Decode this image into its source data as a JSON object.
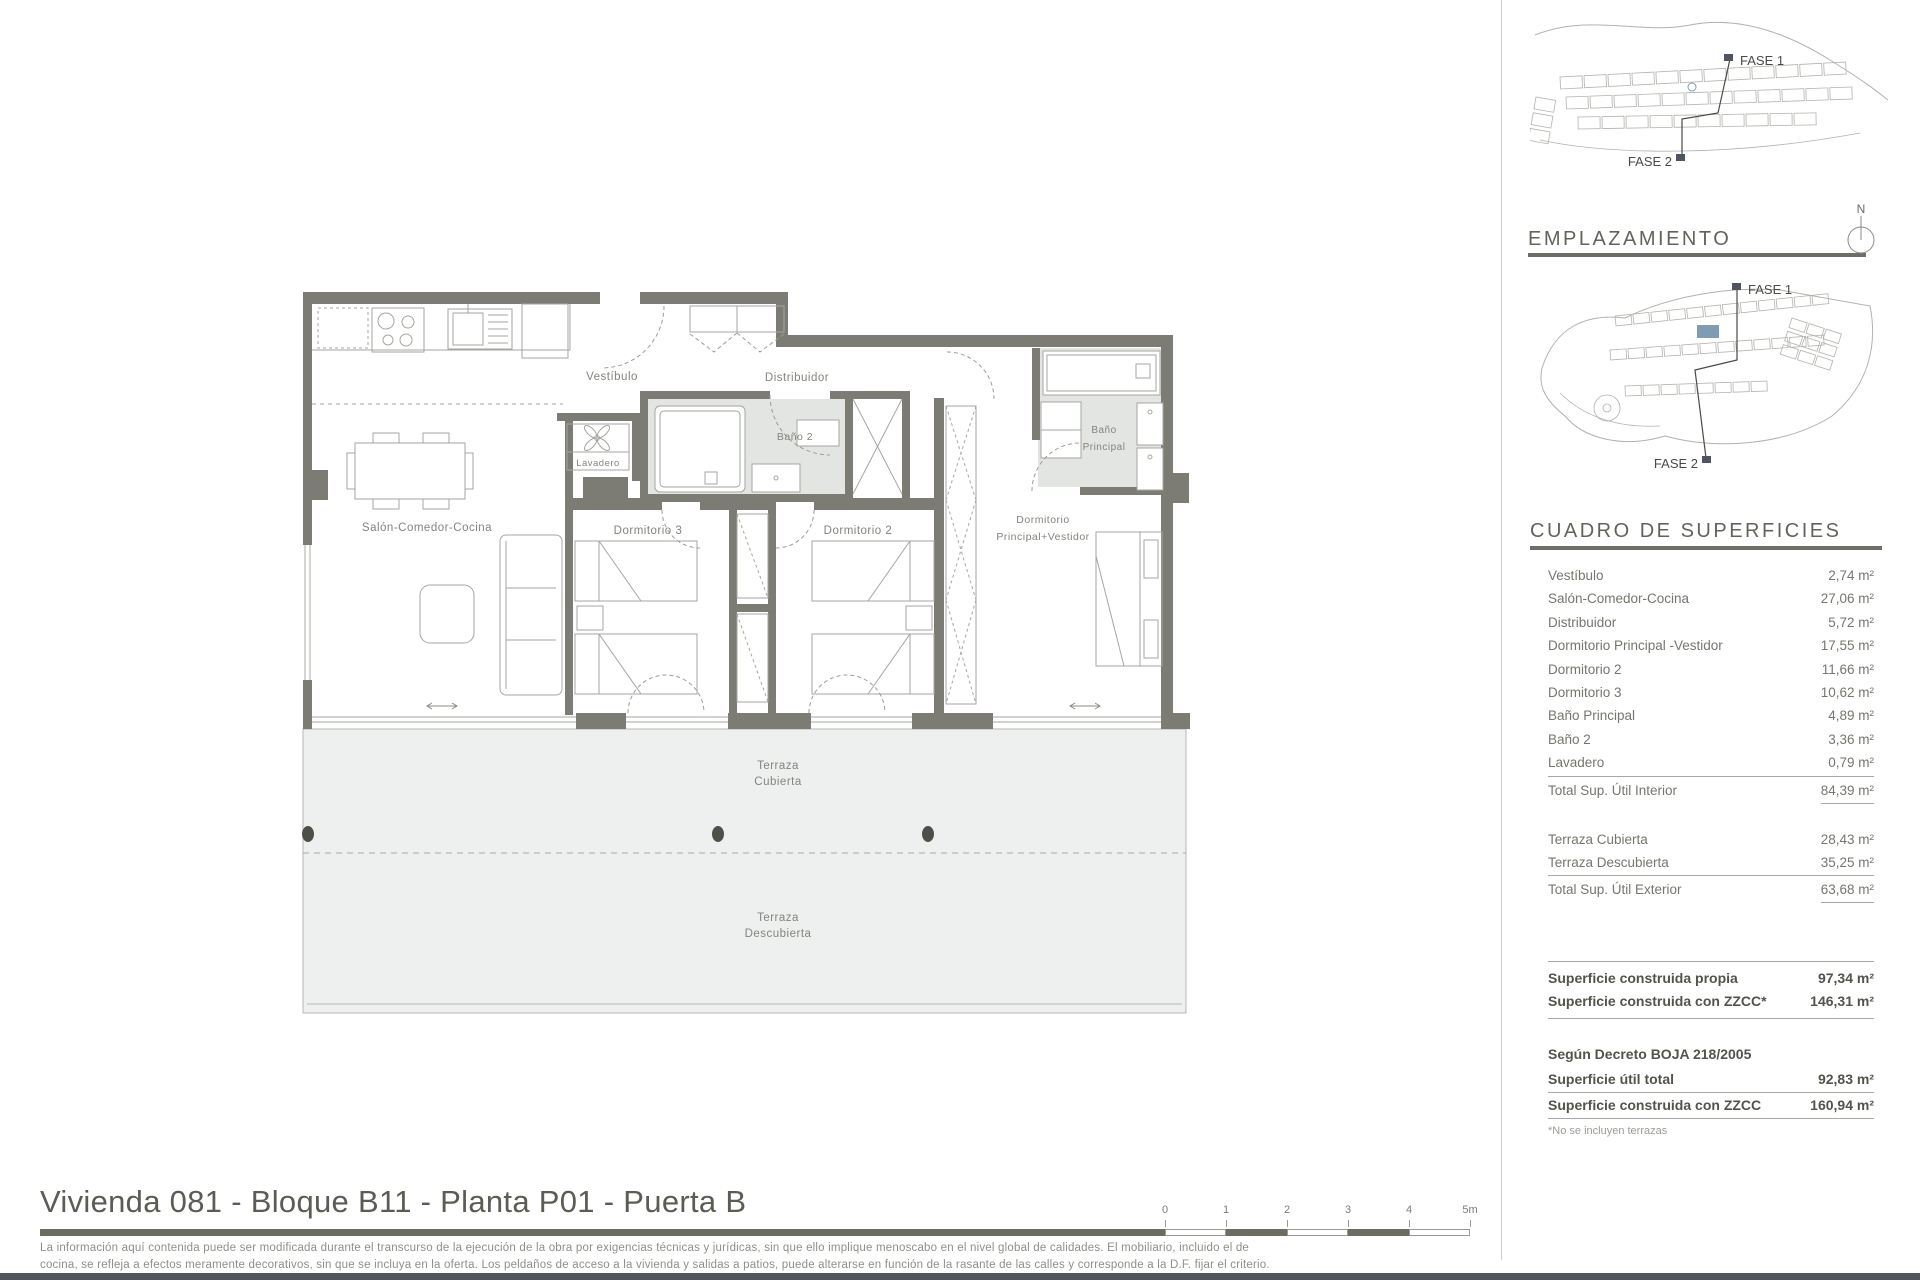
{
  "plan": {
    "labels": {
      "vestibulo": "Vestíbulo",
      "distribuidor": "Distribuidor",
      "bano2": "Baño 2",
      "lavadero": "Lavadero",
      "salon": "Salón-Comedor-Cocina",
      "dorm3": "Dormitorio 3",
      "dorm2": "Dormitorio 2",
      "dormppal_line1": "Dormitorio",
      "dormppal_line2": "Principal+Vestidor",
      "banoppal_line1": "Baño",
      "banoppal_line2": "Principal",
      "terraza_cubierta_line1": "Terraza",
      "terraza_cubierta_line2": "Cubierta",
      "terraza_descubierta_line1": "Terraza",
      "terraza_descubierta_line2": "Descubierta"
    },
    "scalebar_labels": [
      "0",
      "1",
      "2",
      "3",
      "4",
      "5m"
    ]
  },
  "sidebar": {
    "site_overview": {
      "fase1": "FASE 1",
      "fase2": "FASE 2"
    },
    "emplazamiento": {
      "title": "EMPLAZAMIENTO",
      "north": "N",
      "fase1": "FASE 1",
      "fase2": "FASE 2"
    },
    "cuadro": {
      "title": "CUADRO DE SUPERFICIES",
      "interior_rows": [
        {
          "label": "Vestíbulo",
          "value": "2,74 m²"
        },
        {
          "label": "Salón-Comedor-Cocina",
          "value": "27,06 m²"
        },
        {
          "label": "Distribuidor",
          "value": "5,72 m²"
        },
        {
          "label": "Dormitorio Principal -Vestidor",
          "value": "17,55 m²"
        },
        {
          "label": "Dormitorio 2",
          "value": "11,66 m²"
        },
        {
          "label": "Dormitorio 3",
          "value": "10,62 m²"
        },
        {
          "label": "Baño Principal",
          "value": "4,89 m²"
        },
        {
          "label": "Baño 2",
          "value": "3,36 m²"
        },
        {
          "label": "Lavadero",
          "value": "0,79 m²"
        }
      ],
      "interior_total": {
        "label": "Total Sup. Útil Interior",
        "value": "84,39 m²"
      },
      "exterior_rows": [
        {
          "label": "Terraza Cubierta",
          "value": "28,43 m²"
        },
        {
          "label": "Terraza Descubierta",
          "value": "35,25 m²"
        }
      ],
      "exterior_total": {
        "label": "Total Sup. Útil Exterior",
        "value": "63,68 m²"
      },
      "construida_rows": [
        {
          "label": "Superficie construida propia",
          "value": "97,34 m²"
        },
        {
          "label": "Superficie construida con ZZCC*",
          "value": "146,31 m²"
        }
      ],
      "decreto_title": "Según Decreto BOJA 218/2005",
      "decreto_rows": [
        {
          "label": "Superficie útil total",
          "value": "92,83 m²"
        },
        {
          "label": "Superficie construida con ZZCC",
          "value": "160,94 m²"
        }
      ],
      "footnote": "*No se incluyen terrazas"
    }
  },
  "footer": {
    "title": "Vivienda 081 - Bloque B11 - Planta P01 - Puerta B",
    "disclaimer_line1": "La información aquí contenida puede ser modificada durante el transcurso de la ejecución de la obra por exigencias técnicas y jurídicas, sin que ello implique menoscabo en el nivel global de calidades. El mobiliario, incluido el de",
    "disclaimer_line2": "cocina, se refleja a efectos meramente decorativos, sin que se incluya en la oferta. Los peldaños de acceso a la vivienda y salidas a patios, puede alterarse en función de la rasante de las calles y corresponde a la D.F. fijar el criterio."
  },
  "colors": {
    "wall_gray": "#7c7c74",
    "terrace_gray": "#eef0ef",
    "bath_gray": "#e3e5e3",
    "accent_blue": "#7f9cb5",
    "title_rule": "#6c6c62",
    "bottom_border": "#51565d"
  }
}
